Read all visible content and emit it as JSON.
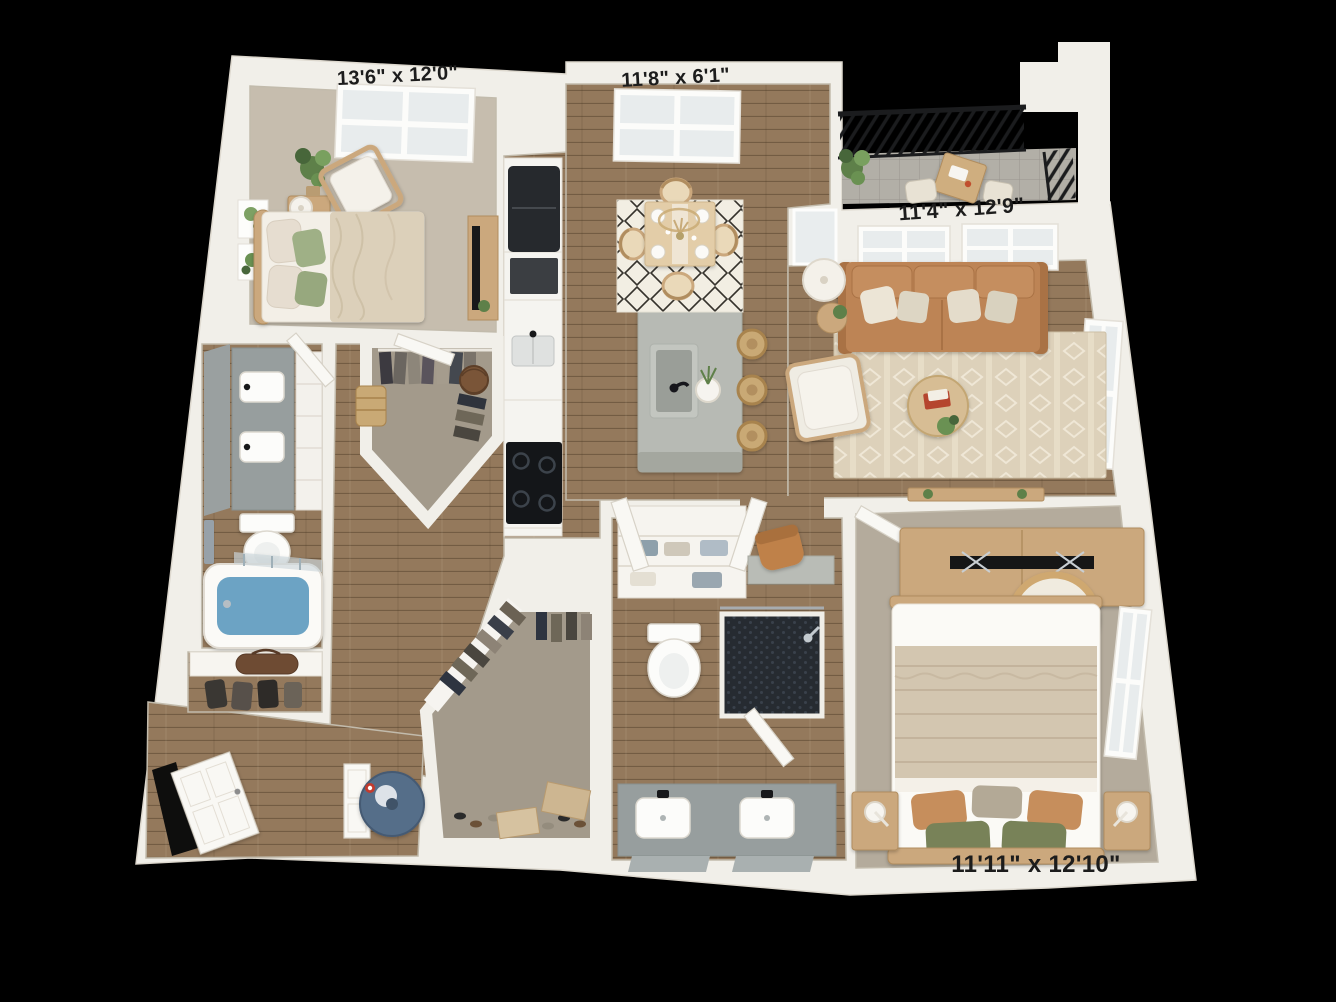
{
  "image_type": "3d-apartment-floor-plan",
  "background": "#000000",
  "rooms": {
    "bedroom1": {
      "label": "13'6\" x 12'0\""
    },
    "dining": {
      "label": "11'8\" x 6'1\""
    },
    "living": {
      "label": "11'4\" x 12'9\""
    },
    "bedroom2": {
      "label": "11'11\" x 12'10\""
    }
  },
  "colors": {
    "bg": "#000000",
    "wall": "#f1efe9",
    "wallEdge": "#ddd8ce",
    "wood": "#94795c",
    "floorLine": "#6f5a42",
    "carpet1": "#c6bdae",
    "carpet2": "#b4ab9c",
    "carpetCloset": "#a39a8b",
    "balconyTile": "#b2afa7",
    "diningRug": "#f2eee3",
    "livingRug": "#ddd1ba",
    "rugAccent": "#efe7d6",
    "sofa": "#bd8455",
    "sofaDark": "#a97244",
    "oak": "#cba87d",
    "oakDark": "#b08d5f",
    "paleWood": "#e3cda8",
    "island": "#b7bab4",
    "islandSide": "#a4a79f",
    "counterWhite": "#f5f4f0",
    "vanityGray": "#979e9e",
    "mirrorGray": "#9aa0a0",
    "appliance": "#26292d",
    "cooktop": "#141619",
    "tubWater": "#6ca3c4",
    "waterHeater": "#546e89",
    "showerTile": "#262b31",
    "plant": "#5e8049",
    "plantDark": "#47663a",
    "door": "#f9f8f4",
    "doorEdge": "#d7d2c7",
    "railing": "#1b1c1e",
    "label": "#1c1c1c"
  }
}
